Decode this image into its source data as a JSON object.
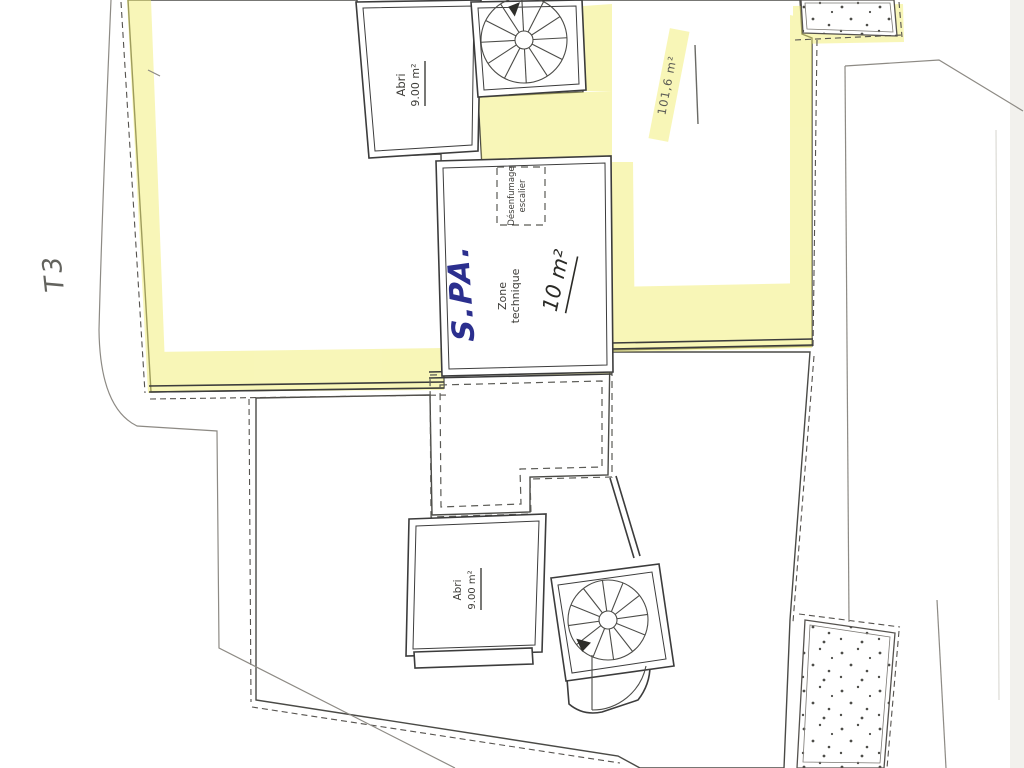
{
  "labels": {
    "shelter_top": {
      "line1": "Abri",
      "line2": "9.00 m²"
    },
    "shelter_bottom": {
      "line1": "Abri",
      "line2": "9.00 m²"
    },
    "technical_zone": {
      "line1": "Zone",
      "line2": "technique",
      "area": "10 m²"
    },
    "smoke_vent": {
      "line1": "Désenfumage",
      "line2": "escalier"
    },
    "handwritten_spa": "S.PA.",
    "terrace_area": "101,6 m²",
    "handwritten_note": "T3"
  },
  "colors": {
    "highlighter": "#f2ee71",
    "ink_blue": "#2b2f8e",
    "paper": "#ffffff",
    "line_dark": "#3c3c3c",
    "line_gray": "#8d8a84"
  }
}
